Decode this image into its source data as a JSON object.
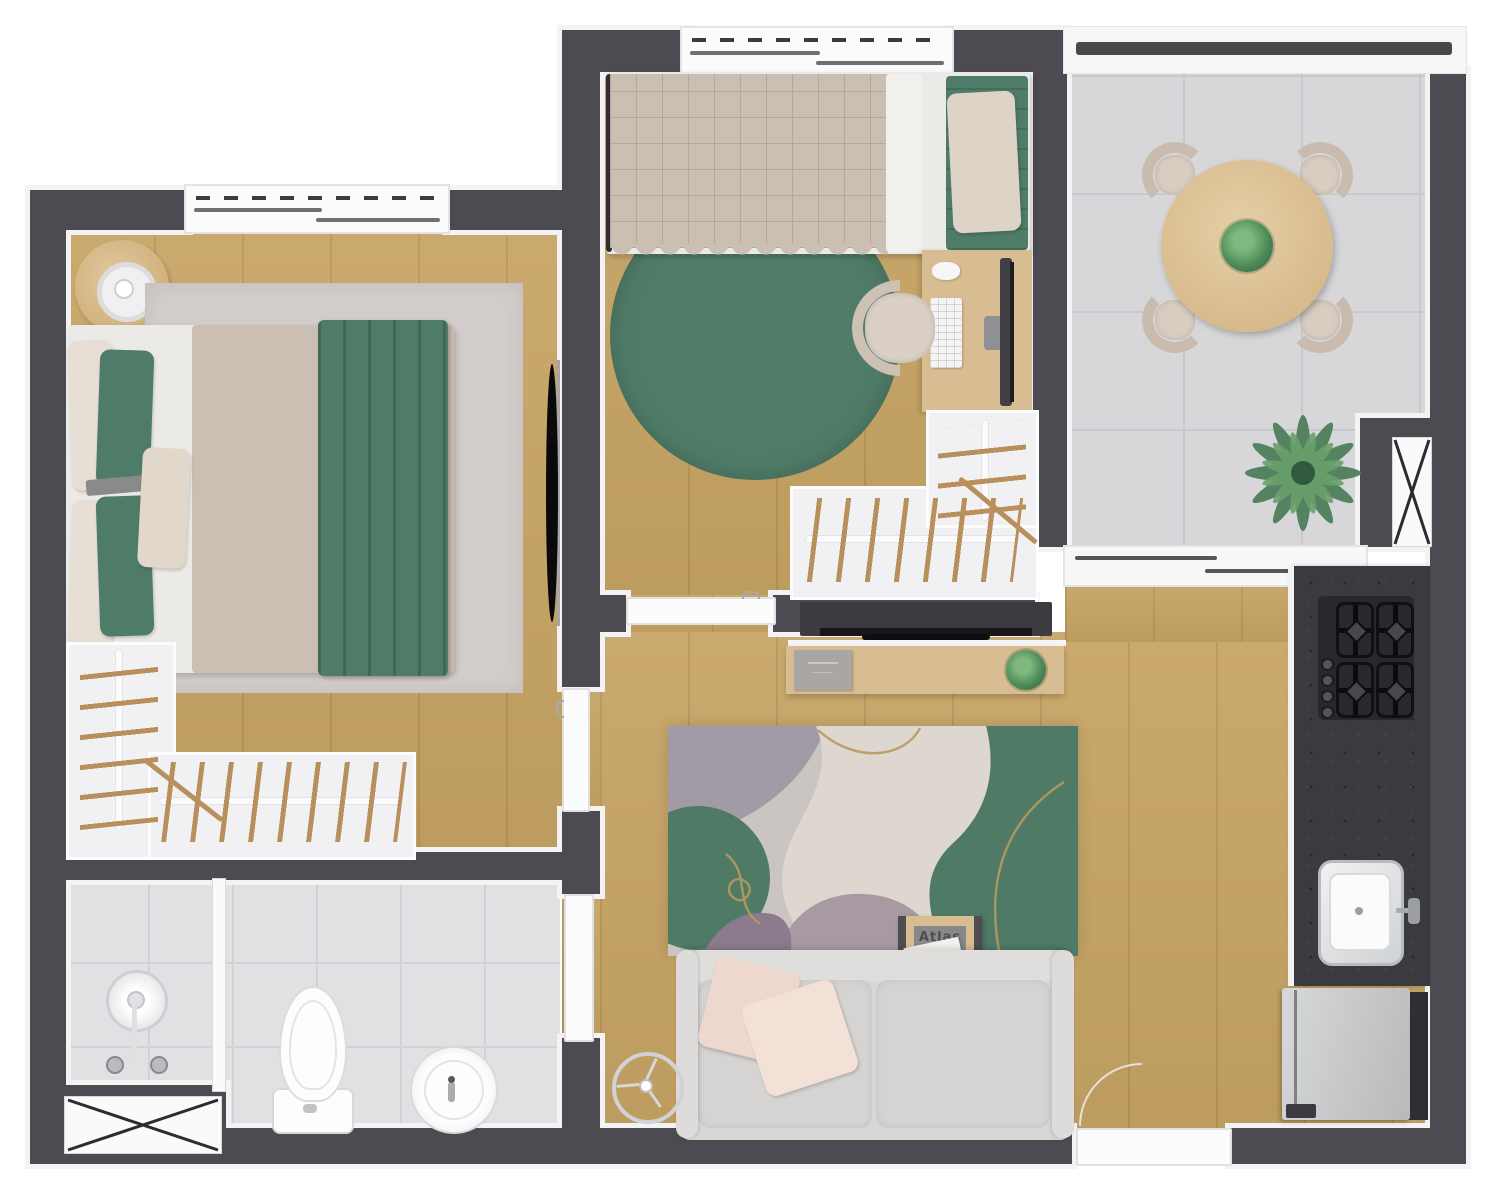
{
  "palette": {
    "wall": "#4b4b51",
    "wallTrim": "#f3f3f4",
    "wood": "#c7a465",
    "woodLight": "#d9bd92",
    "tile": "#d7d7da",
    "bathTile": "#e1e1e4",
    "rugGray": "#d2cdca",
    "green": "#4f7c68",
    "greenDark": "#3f6b54",
    "duvet": "#cbbfb3",
    "bedWhite": "#eceae6",
    "pillowPink": "#eed8cd",
    "sofaGray": "#d8d7d5",
    "counter": "#3a3a3f",
    "cooktop": "#28282d",
    "steel": "#c9cbcd",
    "hanger": "#b98f5c",
    "closetBg": "#f1f1f4",
    "gold": "#b89a5e",
    "mauve": "#a29aa4",
    "purple": "#8b7b8d",
    "cream": "#ddd7cf",
    "chairBeige": "#c9bcae"
  },
  "rooms": {
    "bedroom1": {
      "name": "Bedroom 1"
    },
    "bedroom2": {
      "name": "Bedroom 2 / Office"
    },
    "bathroom": {
      "name": "Bathroom"
    },
    "living": {
      "name": "Living Room"
    },
    "kitchen": {
      "name": "Kitchen"
    },
    "balcony": {
      "name": "Balcony / Terrace"
    }
  },
  "book": {
    "top": "Atlas",
    "bottom": "Ando"
  }
}
